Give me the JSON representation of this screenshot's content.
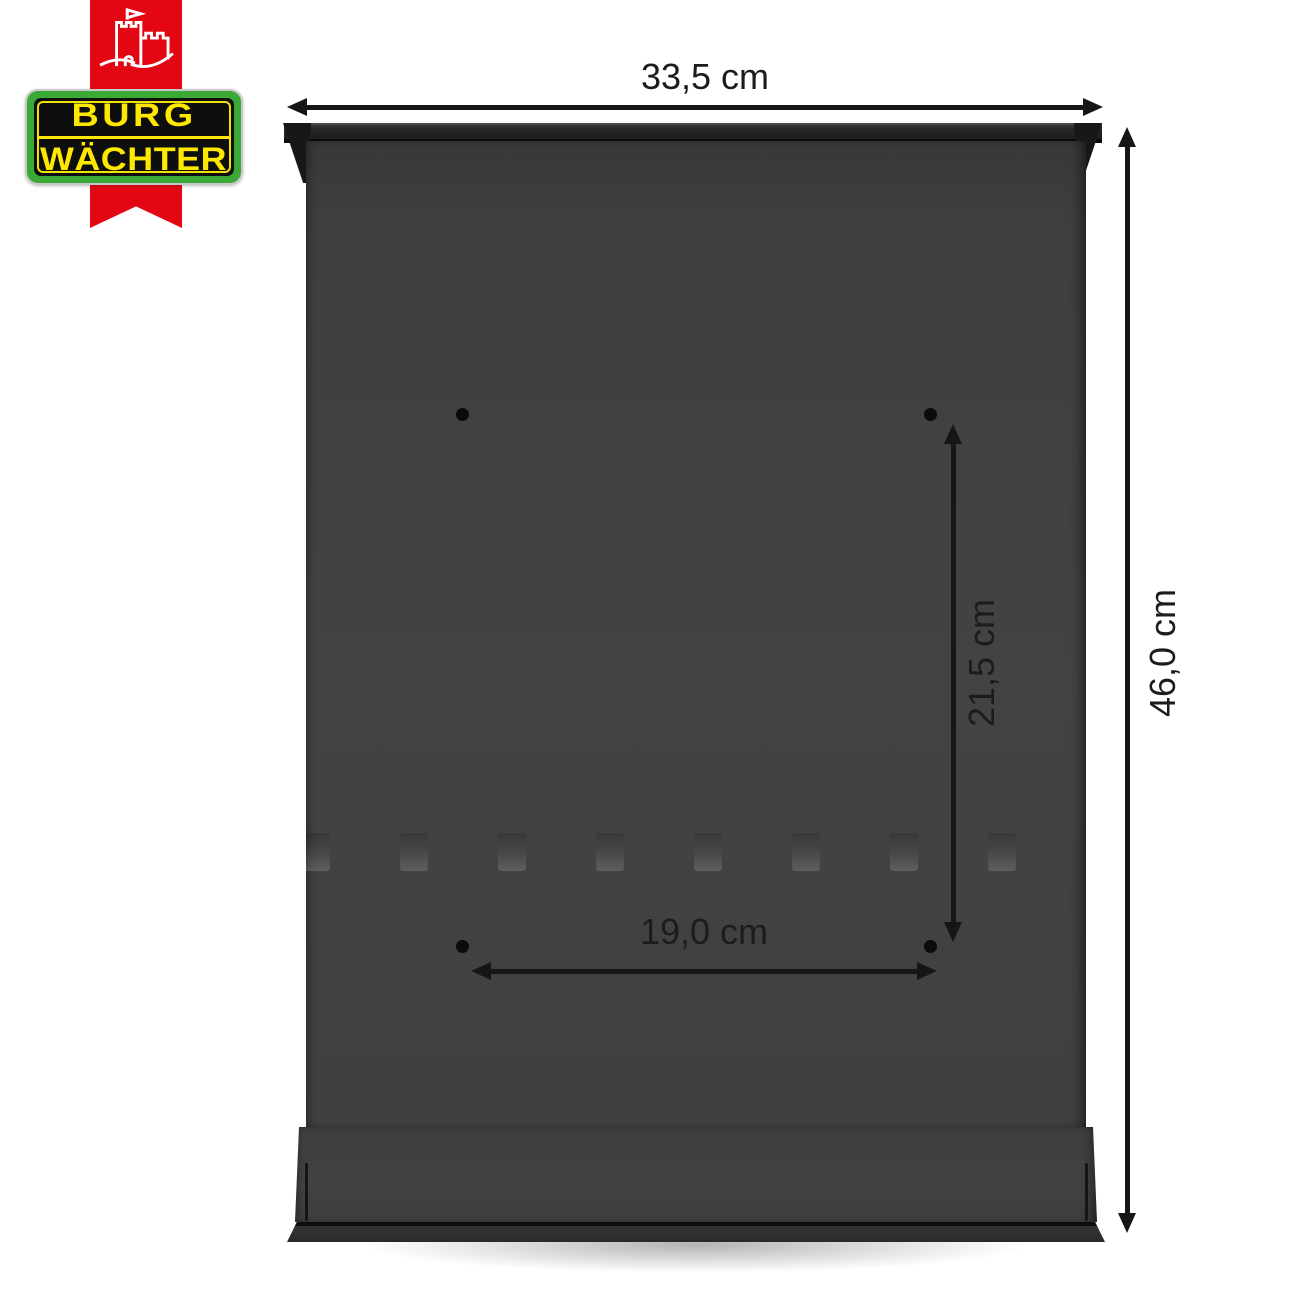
{
  "page": {
    "background_color": "#ffffff"
  },
  "logo": {
    "icon": "castle-flag-icon",
    "ribbon_color": "#e30613",
    "badge": {
      "line1": "BURG",
      "line2": "WÄCHTER",
      "text_color": "#ffe800",
      "frame_color": "#3aa935",
      "field_color": "#0e0e0e",
      "edge_color": "#c9c9c9"
    }
  },
  "product": {
    "body_color": "#414143",
    "mounting_hole_count": 4
  },
  "annotations": {
    "line_color": "#161616",
    "overall_width": "33,5 cm",
    "overall_height": "46,0 cm",
    "hole_spacing_vertical": "21,5 cm",
    "hole_spacing_horizontal": "19,0 cm"
  }
}
